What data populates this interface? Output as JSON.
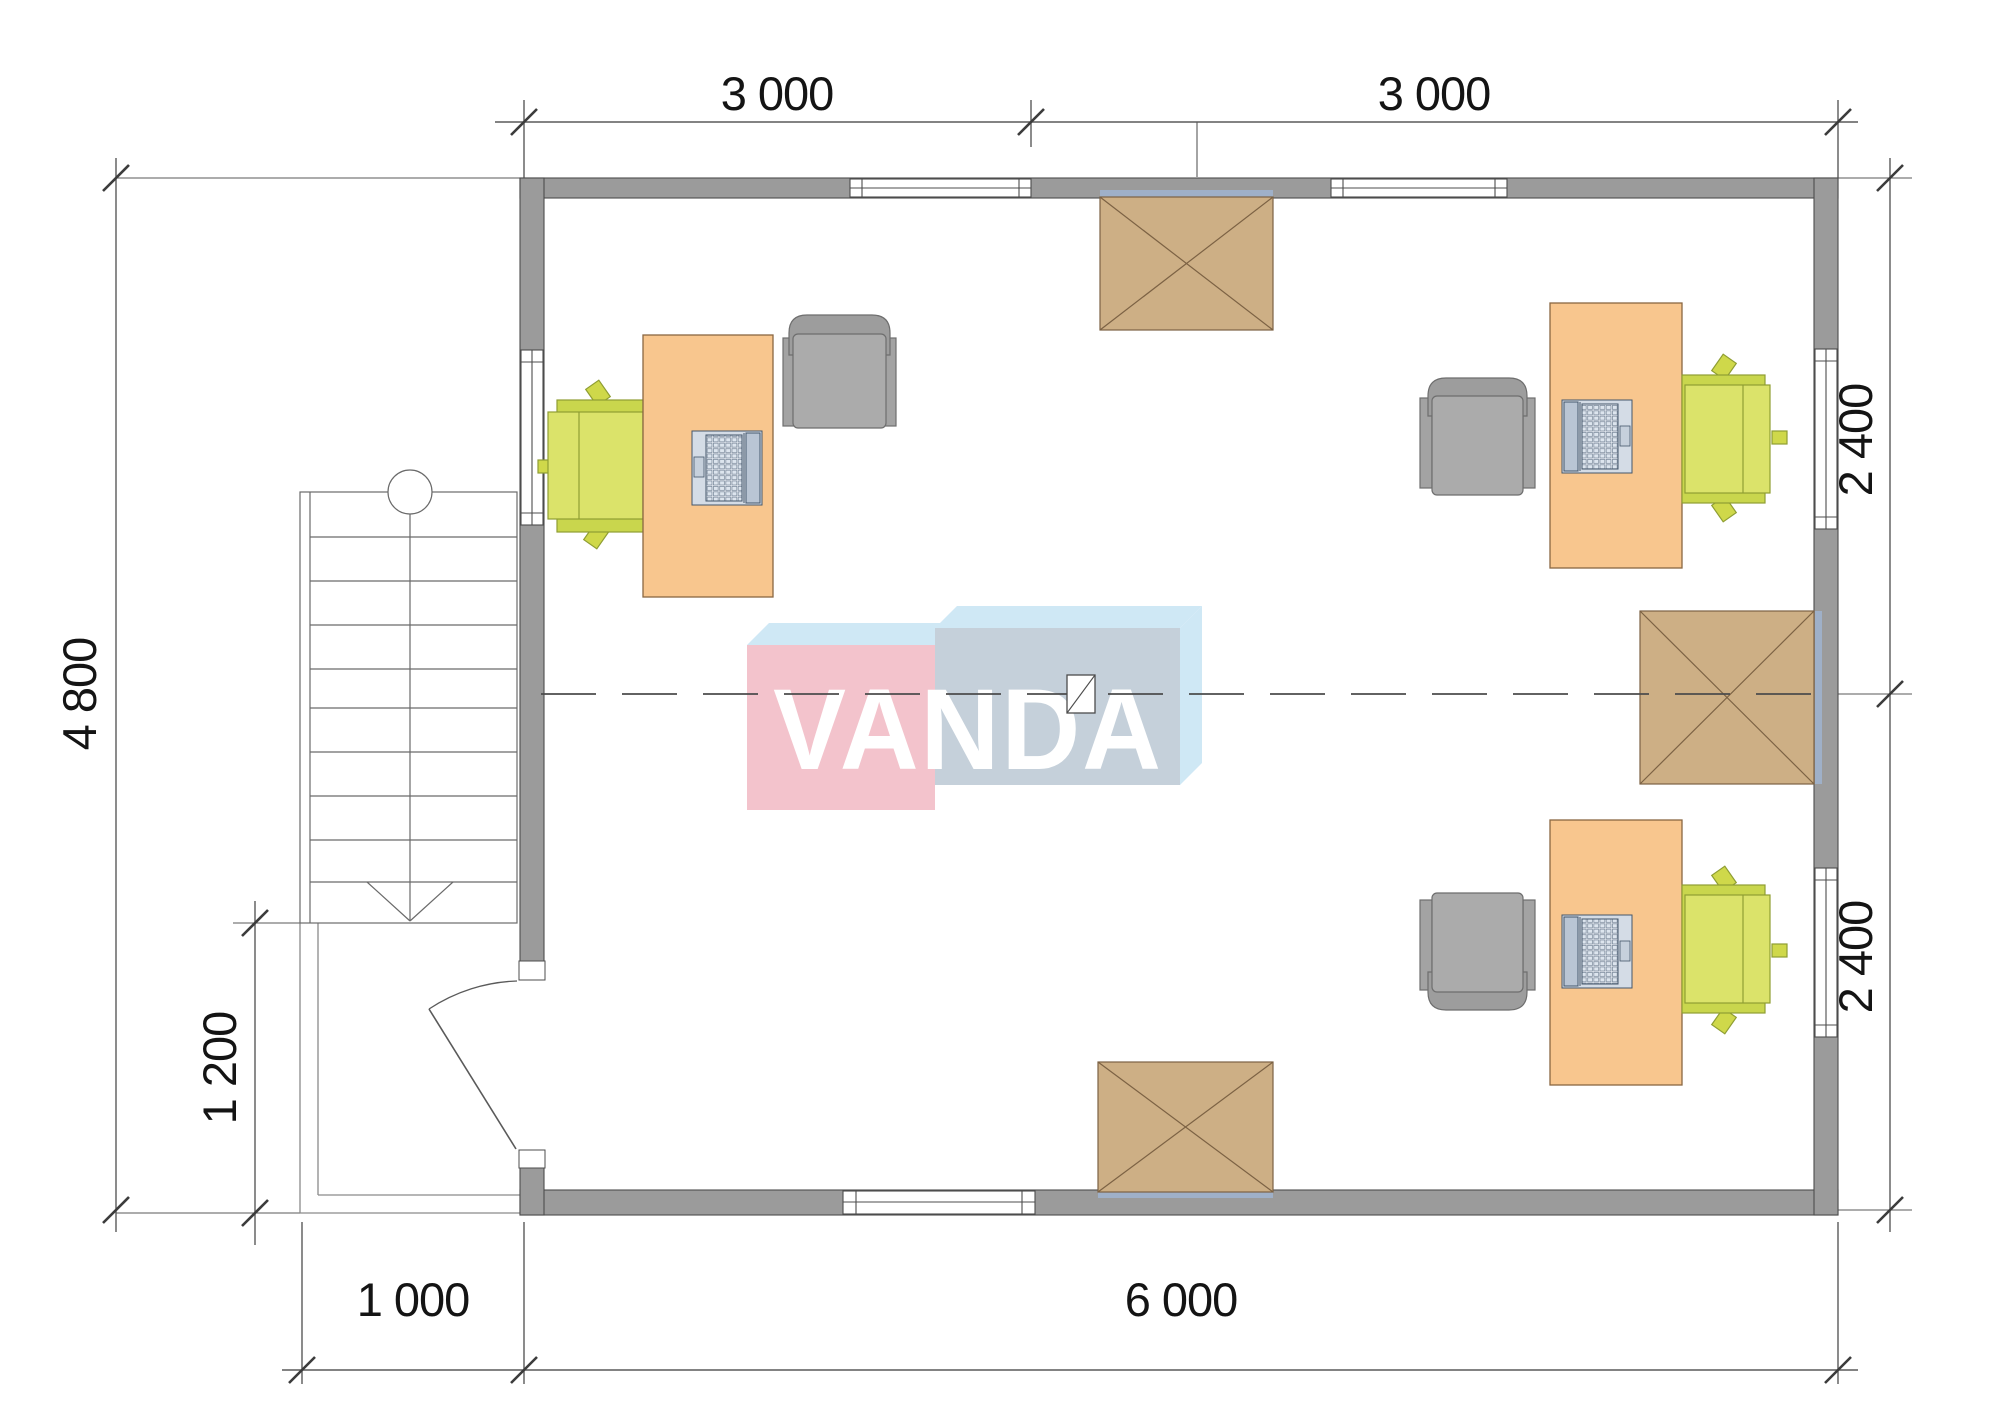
{
  "watermark": {
    "text": "VANDA"
  },
  "dimensions": {
    "top_left": "3 000",
    "top_right": "3 000",
    "left_height": "4 800",
    "porch_height": "1 200",
    "bottom_porch": "1 000",
    "bottom_main": "6 000",
    "right_upper": "2 400",
    "right_lower": "2 400"
  },
  "colors": {
    "wall": "#9b9b9b",
    "wall_outline": "#4d4d4d",
    "desk": "#f8c68e",
    "chair_green": "#d5df62",
    "chair_green_dark": "#c9d64d",
    "chair_gray": "#a9a9a9",
    "hatch_square": "#cdaf85",
    "lintel": "#9fb0c8",
    "laptop": "#d4dce6",
    "logo_pink": "#f3c3cc",
    "logo_blue": "#c5d0da",
    "logo_top": "#cfe8f5",
    "dimension_text": "#141414"
  }
}
